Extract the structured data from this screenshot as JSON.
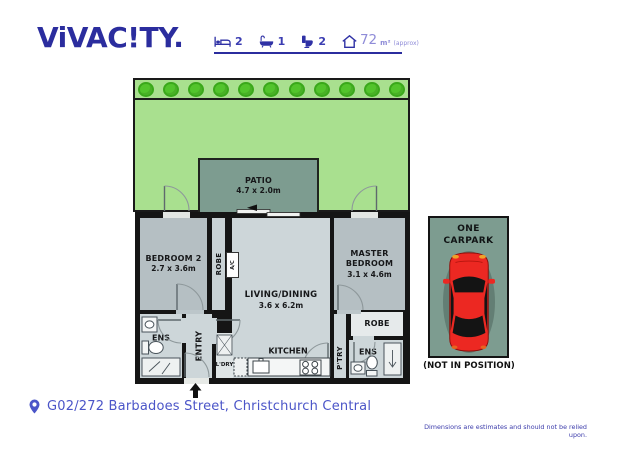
{
  "brand": {
    "logo": "ViVAC!TY."
  },
  "stats": {
    "bed": "2",
    "bath": "1",
    "toilet": "2",
    "area_value": "72",
    "area_unit": "m²",
    "area_qualifier": "(approx)"
  },
  "garden": {
    "bush_count": 11
  },
  "plan": {
    "patio_name": "PATIO",
    "patio_dims": "4.7 x 2.0m",
    "bedroom2_name": "BEDROOM 2",
    "bedroom2_dims": "2.7 x 3.6m",
    "robe1": "ROBE",
    "ac": "A/C",
    "living_name": "LIVING/DINING",
    "living_dims": "3.6 x 6.2m",
    "master_name": "MASTER BEDROOM",
    "master_dims": "3.1 x 4.6m",
    "robe2": "ROBE",
    "ens1": "ENS",
    "entry": "ENTRY",
    "wd": "W/D",
    "ldry": "L'DRY",
    "fridge": "F",
    "kitchen": "KITCHEN",
    "ptry": "P'TRY",
    "ens2": "ENS"
  },
  "carpark": {
    "line1": "ONE",
    "line2": "CARPARK",
    "note": "(NOT IN POSITION)"
  },
  "footer": {
    "address": "G02/272 Barbadoes Street, Christchurch Central",
    "disclaimer": "Dimensions are estimates and should not be relied upon."
  },
  "colors": {
    "brand_navy": "#2b2d9e",
    "area_lavender": "#8f8cd8",
    "address_blue": "#4b55c8",
    "garden_green": "#a9e08f",
    "bush_green": "#52c42c",
    "patio_grey_green": "#7d9c90",
    "room_light": "#cdd6d9",
    "room_dark": "#b5bfc3",
    "wall_black": "#151515",
    "car_red": "#ec2822"
  }
}
